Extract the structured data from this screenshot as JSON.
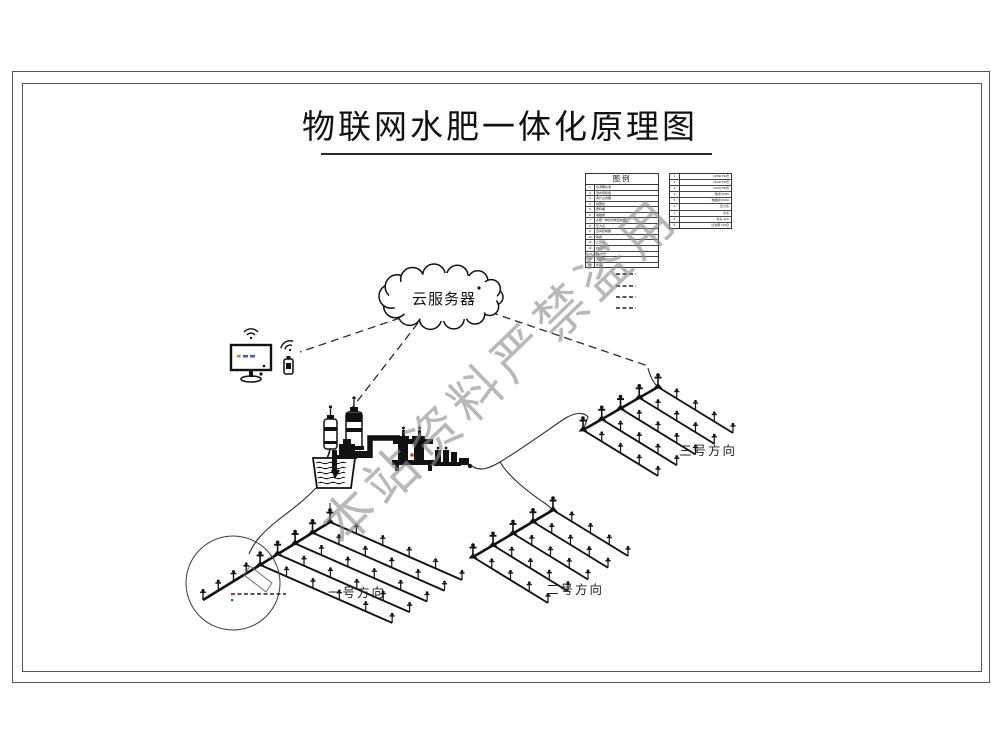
{
  "title": "物联网水肥一体化原理图",
  "watermark": "本站资料严禁盗用",
  "cloud": {
    "label": "云服务器"
  },
  "fields": [
    {
      "label": "一号方向"
    },
    {
      "label": "二号方向"
    },
    {
      "label": "三号方向"
    }
  ],
  "legend": {
    "title": "图例",
    "left_rows": [
      {
        "no": "1",
        "name": "水源蓄水池"
      },
      {
        "no": "2",
        "name": "潜水泵机组"
      },
      {
        "no": "3",
        "name": "叠片过滤器"
      },
      {
        "no": "4",
        "name": "施肥机"
      },
      {
        "no": "5",
        "name": "肥料桶"
      },
      {
        "no": "6",
        "name": "电磁阀"
      },
      {
        "no": "7",
        "name": "水肥一体化智能控制器"
      },
      {
        "no": "8",
        "name": "压力表"
      },
      {
        "no": "9",
        "name": "田间控制器"
      },
      {
        "no": "10",
        "name": "球阀"
      },
      {
        "no": "11",
        "name": "止回阀"
      },
      {
        "no": "12",
        "name": "PE主管"
      },
      {
        "no": "13",
        "name": "PE支管"
      },
      {
        "no": "14",
        "name": "滴灌带"
      },
      {
        "no": "15",
        "name": "喷头"
      }
    ],
    "right_rows": [
      {
        "no": "1",
        "name": "DN50 PE管"
      },
      {
        "no": "2",
        "name": "DN40 PE管"
      },
      {
        "no": "3",
        "name": "DN32 PE管"
      },
      {
        "no": "4",
        "name": "球阀 DN50"
      },
      {
        "no": "5",
        "name": "电磁阀 DN40"
      },
      {
        "no": "6",
        "name": "压力表"
      },
      {
        "no": "7",
        "name": "水表"
      },
      {
        "no": "8",
        "name": "滴头 4L/h"
      },
      {
        "no": "9",
        "name": "过滤网 120目"
      }
    ],
    "linetype_samples": 4
  },
  "colors": {
    "line": "#1a1a1a",
    "frame": "#555555",
    "watermark": "#8d8d8d",
    "screen_accent_orange": "#d97b2a",
    "screen_accent_blue": "#3a62b8"
  }
}
